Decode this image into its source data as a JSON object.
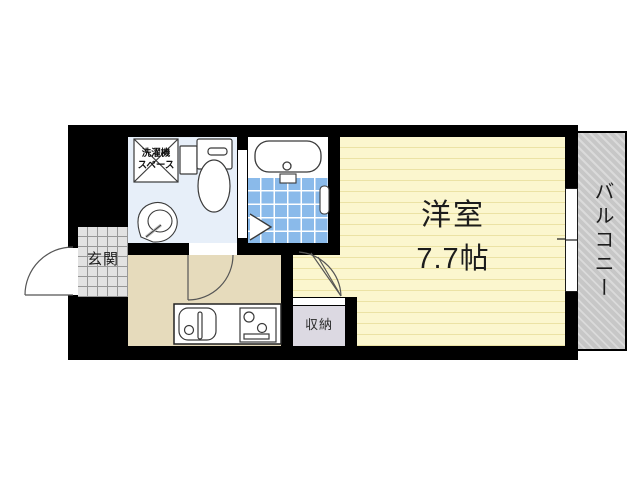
{
  "floorplan": {
    "labels": {
      "western_room": "洋室",
      "western_room_size": "7.7帖",
      "balcony": "バルコニー",
      "entrance": "玄関",
      "storage": "収納",
      "washer_space_line1": "洗濯機",
      "washer_space_line2": "スペース"
    },
    "colors": {
      "wall": "#000000",
      "western_room_fill": "#fbf6ce",
      "western_room_stripe": "#ebe2a4",
      "balcony_fill": "#c7c7c7",
      "balcony_stripe": "#dadada",
      "washroom_fill": "#e7eff9",
      "bath_tile_fill": "#8abaea",
      "entrance_tile_fill": "#e2e2e2",
      "kitchen_fill": "#e6dbbc",
      "storage_fill": "#dcd9e2",
      "fixture_outline": "#3a3a3a"
    }
  }
}
